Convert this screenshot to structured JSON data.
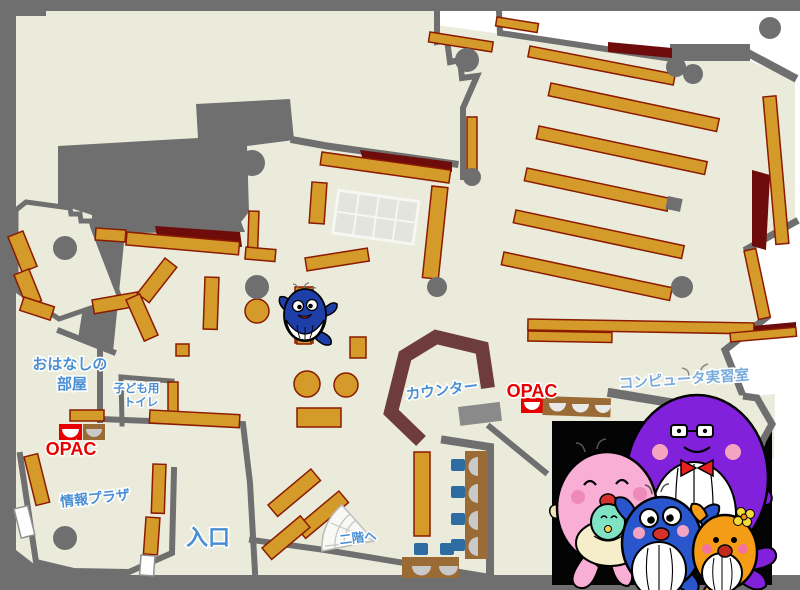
{
  "map": {
    "type": "library-floor-map",
    "labels": {
      "ohanashi_line1": "おはなしの",
      "ohanashi_line2": "部屋",
      "kids_toilet_line1": "子ども用",
      "kids_toilet_line2": "トイレ",
      "opac_left": "OPAC",
      "info_plaza": "情報プラザ",
      "entrance": "入口",
      "counter": "カウンター",
      "opac_center": "OPAC",
      "computer_room": "コンピュータ実習室",
      "to_second_floor": "二階へ"
    },
    "colors": {
      "floor": "#ebebdc",
      "wall_gray": "#6f6f6f",
      "shelf_orange": "#d49a2a",
      "shelf_border": "#8b1a00",
      "dark_red": "#6e0b0b",
      "counter_maroon": "#6e3c3c",
      "label_blue": "#4a8fd3",
      "opac_red": "#e60000",
      "chair_blue": "#2d6ca3",
      "desk_brown": "#9a6b35",
      "mascot_purple": "#8121dc",
      "mascot_pink": "#f9aed6",
      "mascot_blue": "#2956cc",
      "mascot_orange": "#f59c16"
    },
    "mascots": {
      "family": [
        "purple-father-whale",
        "pink-mother-whale",
        "blue-child-whale",
        "orange-child-whale"
      ],
      "solo": "small-blue-whale"
    }
  }
}
